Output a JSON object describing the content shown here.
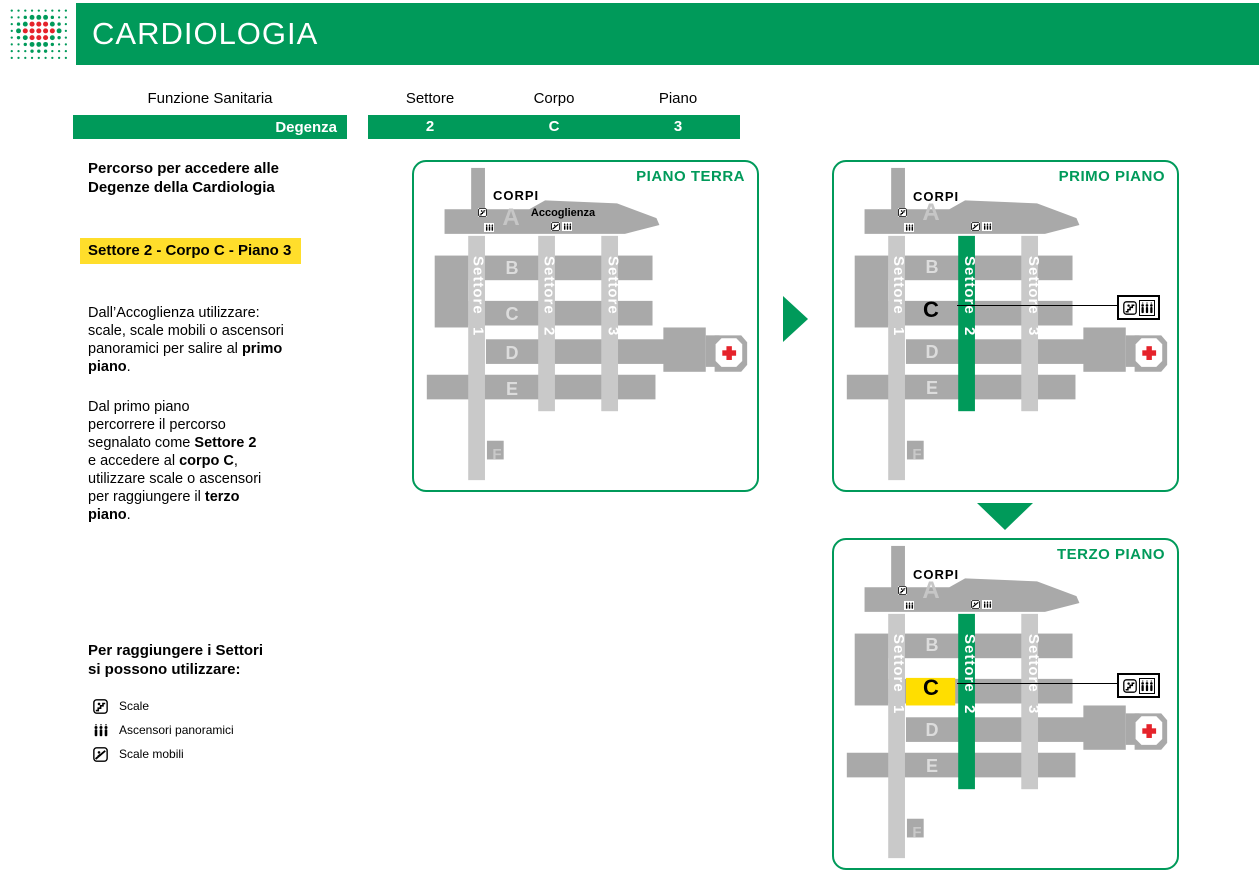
{
  "colors": {
    "green": "#009A5A",
    "yellow": "#FFDE00",
    "dark_gray": "#A9A9A9",
    "light_gray": "#C9C9C9",
    "red_cross": "#E5232B"
  },
  "header": {
    "title": "CARDIOLOGIA"
  },
  "route": {
    "funzione_label": "Funzione Sanitaria",
    "funzione_value": "Degenza",
    "columns": [
      {
        "label": "Settore",
        "value": "2"
      },
      {
        "label": "Corpo",
        "value": "C"
      },
      {
        "label": "Piano",
        "value": "3"
      }
    ]
  },
  "intro": {
    "line1": "Percorso per accedere alle",
    "line2": "Degenze della Cardiologia"
  },
  "highlight": "Settore 2 - Corpo C - Piano 3",
  "para1": {
    "l1": "Dall’Accoglienza utilizzare:",
    "l2": "scale, scale mobili o ascensori",
    "l3": "panoramici per salire al ",
    "b1": "primo",
    "b2": "piano",
    "tail": "."
  },
  "para2": {
    "l1": "Dal primo piano",
    "l2": "percorrere il percorso",
    "l3": "segnalato come ",
    "b1": "Settore 2",
    "l4": "e accedere al ",
    "b2": "corpo C",
    "c1": ",",
    "l5": "utilizzare scale o ascensori",
    "l6": "per raggiungere il ",
    "b3": "terzo",
    "b4": "piano",
    "tail": "."
  },
  "legend": {
    "heading1": "Per raggiungere i Settori",
    "heading2": "si possono utilizzare:",
    "items": [
      {
        "icon": "stairs-icon",
        "label": "Scale"
      },
      {
        "icon": "panoramic-elevator-icon",
        "label": "Ascensori panoramici"
      },
      {
        "icon": "escalator-icon",
        "label": "Scale mobili"
      }
    ]
  },
  "floors": [
    {
      "title": "PIANO TERRA",
      "corpi": "CORPI",
      "accoglienza": "Accoglienza",
      "sectors": [
        {
          "word": "Settore",
          "num": "1"
        },
        {
          "word": "Settore",
          "num": "2"
        },
        {
          "word": "Settore",
          "num": "3"
        }
      ],
      "bodies": {
        "a": "A",
        "b": "B",
        "c": "C",
        "d": "D",
        "e": "E",
        "f": "F"
      }
    },
    {
      "title": "PRIMO PIANO",
      "corpi": "CORPI",
      "sectors": [
        {
          "word": "Settore",
          "num": "1"
        },
        {
          "word": "Settore",
          "num": "2"
        },
        {
          "word": "Settore",
          "num": "3"
        }
      ],
      "bodies": {
        "a": "A",
        "b": "B",
        "c": "C",
        "d": "D",
        "e": "E",
        "f": "F"
      }
    },
    {
      "title": "TERZO PIANO",
      "corpi": "CORPI",
      "sectors": [
        {
          "word": "Settore",
          "num": "1"
        },
        {
          "word": "Settore",
          "num": "2"
        },
        {
          "word": "Settore",
          "num": "3"
        }
      ],
      "bodies": {
        "a": "A",
        "b": "B",
        "c": "C",
        "d": "D",
        "e": "E",
        "f": "F"
      }
    }
  ]
}
